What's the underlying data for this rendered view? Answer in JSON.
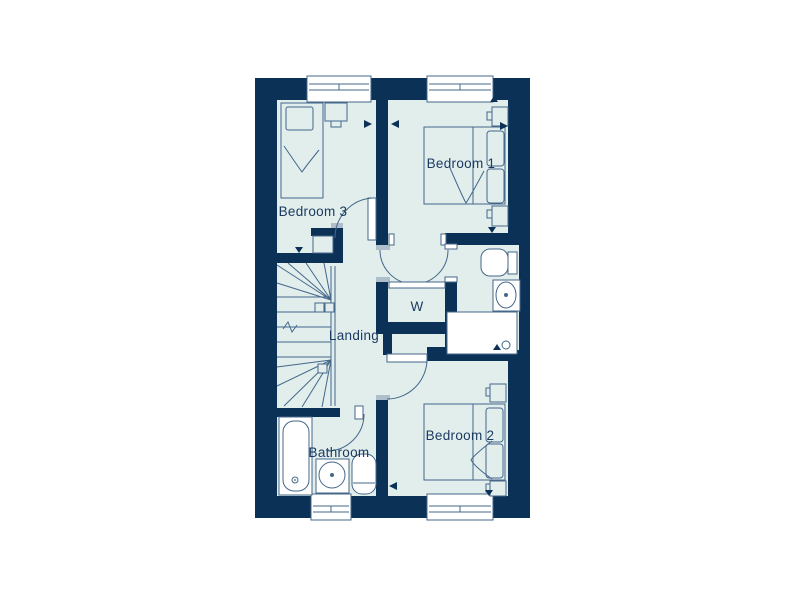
{
  "floor_plan": {
    "type": "residential-floorplan-diagram",
    "labels": {
      "bedroom1": "Bedroom 1",
      "bedroom2": "Bedroom 2",
      "bedroom3": "Bedroom 3",
      "landing": "Landing",
      "bathroom": "Bathroom",
      "wardrobe": "W"
    },
    "colors": {
      "wall": "#0b3157",
      "floor": "#e1eeec",
      "line": "#44678a",
      "cap": "#aebfcb",
      "text": "#1c3a61",
      "white": "#ffffff"
    }
  }
}
